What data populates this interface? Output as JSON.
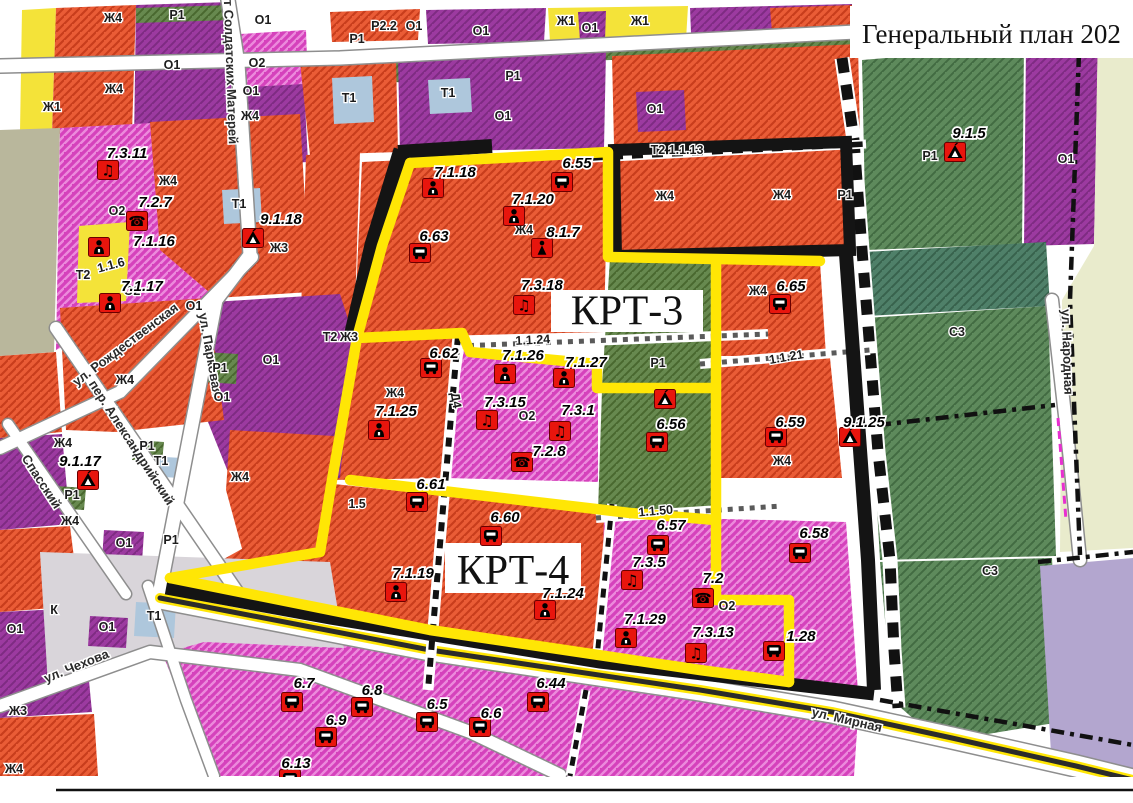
{
  "title": {
    "text": "Генеральный план 202"
  },
  "krt_areas": [
    {
      "label": "КРТ-3",
      "x": 551,
      "y": 290,
      "w": 152,
      "h": 42,
      "fs": 38
    },
    {
      "label": "КРТ-4",
      "x": 445,
      "y": 543,
      "w": 136,
      "h": 50,
      "fs": 42
    }
  ],
  "colors": {
    "boundary_yellow": "#FFE605",
    "boundary_black": "#141414",
    "badge_red": "#E8150D",
    "badge_border": "#6b0000",
    "zone_orange": "#EA5C36",
    "zone_orange_stripe": "#C83D1C",
    "zone_magenta": "#D542BC",
    "zone_magenta_stripe": "#EC8ADC",
    "zone_purple": "#9C3AA0",
    "zone_purple_stripe": "#7E2B82",
    "zone_yellow": "#F4E339",
    "zone_green": "#67894F",
    "zone_dark_green": "#5E8A5C",
    "zone_teal": "#4F8069",
    "zone_gray": "#D9D5DA",
    "zone_light_blue": "#AEC7DC",
    "zone_beige": "#E9EBCC",
    "zone_light_purple": "#B3A6CF",
    "zone_olive": "#B9B79C"
  },
  "markers": [
    {
      "label": "7.3.11",
      "icon": "music",
      "x": 108,
      "y": 170,
      "lx": 127,
      "ly": 158
    },
    {
      "label": "7.2.7",
      "icon": "phone",
      "x": 137,
      "y": 221,
      "lx": 155,
      "ly": 207
    },
    {
      "label": "7.1.16",
      "icon": "person",
      "x": 99,
      "y": 247,
      "lx": 154,
      "ly": 246
    },
    {
      "label": "7.1.17",
      "icon": "person",
      "x": 110,
      "y": 303,
      "lx": 142,
      "ly": 291
    },
    {
      "label": "9.1.18",
      "icon": "tent",
      "x": 253,
      "y": 238,
      "lx": 281,
      "ly": 224
    },
    {
      "label": "9.1.17",
      "icon": "tent",
      "x": 88,
      "y": 480,
      "lx": 80,
      "ly": 466
    },
    {
      "label": "7.1.18",
      "icon": "person",
      "x": 433,
      "y": 188,
      "lx": 455,
      "ly": 177
    },
    {
      "label": "6.55",
      "icon": "bus",
      "x": 562,
      "y": 182,
      "lx": 577,
      "ly": 168
    },
    {
      "label": "7.1.20",
      "icon": "person",
      "x": 514,
      "y": 216,
      "lx": 533,
      "ly": 204
    },
    {
      "label": "8.1.7",
      "icon": "figure",
      "x": 542,
      "y": 248,
      "lx": 563,
      "ly": 237
    },
    {
      "label": "6.63",
      "icon": "bus",
      "x": 420,
      "y": 253,
      "lx": 434,
      "ly": 241
    },
    {
      "label": "7.3.18",
      "icon": "music",
      "x": 524,
      "y": 305,
      "lx": 542,
      "ly": 290
    },
    {
      "label": "6.65",
      "icon": "bus",
      "x": 780,
      "y": 304,
      "lx": 791,
      "ly": 291
    },
    {
      "label": "6.62",
      "icon": "bus",
      "x": 431,
      "y": 368,
      "lx": 444,
      "ly": 358
    },
    {
      "label": "7.1.26",
      "icon": "person",
      "x": 505,
      "y": 374,
      "lx": 523,
      "ly": 360
    },
    {
      "label": "7.1.27",
      "icon": "person",
      "x": 564,
      "y": 378,
      "lx": 586,
      "ly": 367
    },
    {
      "label": "7.1.25",
      "icon": "person",
      "x": 379,
      "y": 430,
      "lx": 396,
      "ly": 416
    },
    {
      "label": "7.3.15",
      "icon": "music",
      "x": 487,
      "y": 420,
      "lx": 505,
      "ly": 407
    },
    {
      "label": "7.3.1",
      "icon": "music",
      "x": 560,
      "y": 431,
      "lx": 578,
      "ly": 415
    },
    {
      "label": "7.2.8",
      "icon": "phone",
      "x": 522,
      "y": 462,
      "lx": 549,
      "ly": 456
    },
    {
      "label": "6.56",
      "icon": "bus",
      "x": 657,
      "y": 442,
      "lx": 671,
      "ly": 429
    },
    {
      "label": "",
      "icon": "tent",
      "x": 665,
      "y": 399,
      "lx": 665,
      "ly": 388
    },
    {
      "label": "6.59",
      "icon": "bus",
      "x": 776,
      "y": 437,
      "lx": 790,
      "ly": 427
    },
    {
      "label": "9.1.25",
      "icon": "tent",
      "x": 850,
      "y": 437,
      "lx": 864,
      "ly": 427
    },
    {
      "label": "6.61",
      "icon": "bus",
      "x": 417,
      "y": 502,
      "lx": 431,
      "ly": 489
    },
    {
      "label": "6.60",
      "icon": "bus",
      "x": 491,
      "y": 536,
      "lx": 505,
      "ly": 522
    },
    {
      "label": "7.1.19",
      "icon": "person",
      "x": 396,
      "y": 592,
      "lx": 413,
      "ly": 578
    },
    {
      "label": "7.1.24",
      "icon": "person",
      "x": 545,
      "y": 610,
      "lx": 563,
      "ly": 598
    },
    {
      "label": "6.57",
      "icon": "bus",
      "x": 658,
      "y": 545,
      "lx": 671,
      "ly": 530
    },
    {
      "label": "6.58",
      "icon": "bus",
      "x": 800,
      "y": 553,
      "lx": 814,
      "ly": 538
    },
    {
      "label": "7.3.5",
      "icon": "music",
      "x": 632,
      "y": 580,
      "lx": 649,
      "ly": 567
    },
    {
      "label": "7.2",
      "icon": "phone",
      "x": 703,
      "y": 598,
      "lx": 713,
      "ly": 583
    },
    {
      "label": "7.1.29",
      "icon": "person",
      "x": 626,
      "y": 638,
      "lx": 645,
      "ly": 624
    },
    {
      "label": "7.3.13",
      "icon": "music",
      "x": 696,
      "y": 653,
      "lx": 713,
      "ly": 637
    },
    {
      "label": "1.28",
      "icon": "bus",
      "x": 774,
      "y": 651,
      "lx": 801,
      "ly": 641
    },
    {
      "label": "6.7",
      "icon": "bus",
      "x": 292,
      "y": 702,
      "lx": 304,
      "ly": 688
    },
    {
      "label": "6.8",
      "icon": "bus",
      "x": 362,
      "y": 707,
      "lx": 372,
      "ly": 695
    },
    {
      "label": "6.9",
      "icon": "bus",
      "x": 326,
      "y": 737,
      "lx": 336,
      "ly": 725
    },
    {
      "label": "6.5",
      "icon": "bus",
      "x": 427,
      "y": 722,
      "lx": 437,
      "ly": 709
    },
    {
      "label": "6.6",
      "icon": "bus",
      "x": 480,
      "y": 727,
      "lx": 491,
      "ly": 718
    },
    {
      "label": "6.44",
      "icon": "bus",
      "x": 538,
      "y": 702,
      "lx": 551,
      "ly": 688
    },
    {
      "label": "6.13",
      "icon": "bus",
      "x": 290,
      "y": 779,
      "lx": 296,
      "ly": 768
    },
    {
      "label": "9.1.5",
      "icon": "tent",
      "x": 955,
      "y": 152,
      "lx": 969,
      "ly": 138
    }
  ],
  "zone_labels": [
    {
      "t": "Ж4",
      "x": 113,
      "y": 22
    },
    {
      "t": "Р1",
      "x": 177,
      "y": 19
    },
    {
      "t": "О1",
      "x": 263,
      "y": 24
    },
    {
      "t": "Р2.2",
      "x": 384,
      "y": 30
    },
    {
      "t": "О1",
      "x": 414,
      "y": 30
    },
    {
      "t": "О1",
      "x": 481,
      "y": 35
    },
    {
      "t": "Ж1",
      "x": 566,
      "y": 25
    },
    {
      "t": "О1",
      "x": 590,
      "y": 32
    },
    {
      "t": "Ж1",
      "x": 640,
      "y": 25
    },
    {
      "t": "Р1",
      "x": 357,
      "y": 43
    },
    {
      "t": "О1",
      "x": 172,
      "y": 69
    },
    {
      "t": "О2",
      "x": 257,
      "y": 67
    },
    {
      "t": "О1",
      "x": 251,
      "y": 95
    },
    {
      "t": "Ж4",
      "x": 114,
      "y": 93
    },
    {
      "t": "Ж1",
      "x": 52,
      "y": 111
    },
    {
      "t": "Ж4",
      "x": 250,
      "y": 120
    },
    {
      "t": "Т1",
      "x": 349,
      "y": 102
    },
    {
      "t": "Т1",
      "x": 448,
      "y": 97
    },
    {
      "t": "Р1",
      "x": 513,
      "y": 80
    },
    {
      "t": "О1",
      "x": 503,
      "y": 120
    },
    {
      "t": "О1",
      "x": 655,
      "y": 113
    },
    {
      "t": "Ж4",
      "x": 168,
      "y": 185
    },
    {
      "t": "Ж4",
      "x": 665,
      "y": 200
    },
    {
      "t": "Ж4",
      "x": 782,
      "y": 199
    },
    {
      "t": "Р1",
      "x": 845,
      "y": 199
    },
    {
      "t": "Т2 1.1.13",
      "x": 677,
      "y": 154
    },
    {
      "t": "Т1",
      "x": 239,
      "y": 208
    },
    {
      "t": "Ж3",
      "x": 279,
      "y": 252
    },
    {
      "t": "О2",
      "x": 117,
      "y": 215
    },
    {
      "t": "О2",
      "x": 132,
      "y": 295
    },
    {
      "t": "Т2",
      "x": 83,
      "y": 279
    },
    {
      "t": "1.1.6",
      "x": 112,
      "y": 269,
      "r": -15
    },
    {
      "t": "О1",
      "x": 194,
      "y": 310
    },
    {
      "t": "Р1",
      "x": 220,
      "y": 372
    },
    {
      "t": "О1",
      "x": 222,
      "y": 401
    },
    {
      "t": "О1",
      "x": 271,
      "y": 364
    },
    {
      "t": "Ж4",
      "x": 125,
      "y": 384
    },
    {
      "t": "Ж4",
      "x": 63,
      "y": 447
    },
    {
      "t": "Р1",
      "x": 147,
      "y": 450
    },
    {
      "t": "Т1",
      "x": 161,
      "y": 465
    },
    {
      "t": "Ж4",
      "x": 240,
      "y": 481
    },
    {
      "t": "Ж4",
      "x": 70,
      "y": 525
    },
    {
      "t": "Р1",
      "x": 72,
      "y": 499
    },
    {
      "t": "О1",
      "x": 124,
      "y": 547
    },
    {
      "t": "Р1",
      "x": 171,
      "y": 544
    },
    {
      "t": "К",
      "x": 54,
      "y": 614
    },
    {
      "t": "Т1",
      "x": 154,
      "y": 620
    },
    {
      "t": "О1",
      "x": 107,
      "y": 631
    },
    {
      "t": "О1",
      "x": 15,
      "y": 633
    },
    {
      "t": "Ж3",
      "x": 18,
      "y": 715
    },
    {
      "t": "Ж4",
      "x": 14,
      "y": 773
    },
    {
      "t": "Т2",
      "x": 330,
      "y": 341
    },
    {
      "t": "Ж3",
      "x": 349,
      "y": 341
    },
    {
      "t": "Ж4",
      "x": 395,
      "y": 397
    },
    {
      "t": "Ж4",
      "x": 524,
      "y": 234
    },
    {
      "t": "О2",
      "x": 527,
      "y": 420
    },
    {
      "t": "Р1",
      "x": 658,
      "y": 367
    },
    {
      "t": "Ж4",
      "x": 758,
      "y": 295
    },
    {
      "t": "Р1",
      "x": 930,
      "y": 160
    },
    {
      "t": "С3",
      "x": 957,
      "y": 336
    },
    {
      "t": "С3",
      "x": 990,
      "y": 575
    },
    {
      "t": "О1",
      "x": 1066,
      "y": 163
    },
    {
      "t": "Ж4",
      "x": 782,
      "y": 465
    },
    {
      "t": "О2",
      "x": 727,
      "y": 610
    },
    {
      "t": "1.5",
      "x": 357,
      "y": 508
    },
    {
      "t": "1.1.24",
      "x": 533,
      "y": 344,
      "r": -3
    },
    {
      "t": "1.1.21",
      "x": 787,
      "y": 361,
      "r": -10
    },
    {
      "t": "1.1.50",
      "x": 656,
      "y": 515,
      "r": -5
    },
    {
      "t": "Д4",
      "x": 452,
      "y": 401,
      "r": 80
    }
  ],
  "streets": [
    {
      "name": "пр-т Солдатских Матерей",
      "x": 226,
      "y": 62,
      "r": 88
    },
    {
      "name": "ул. Рождественская",
      "x": 128,
      "y": 348,
      "r": -37
    },
    {
      "name": "пер. Александрийский",
      "x": 128,
      "y": 445,
      "r": 57
    },
    {
      "name": "ул. Парковая",
      "x": 206,
      "y": 355,
      "r": 80
    },
    {
      "name": "Спасский",
      "x": 38,
      "y": 484,
      "r": 57
    },
    {
      "name": "ул. Чехова",
      "x": 78,
      "y": 670,
      "r": -22
    },
    {
      "name": "ул. Мирная",
      "x": 846,
      "y": 724,
      "r": 13
    },
    {
      "name": "ул. Народная",
      "x": 1063,
      "y": 352,
      "r": 88
    }
  ]
}
